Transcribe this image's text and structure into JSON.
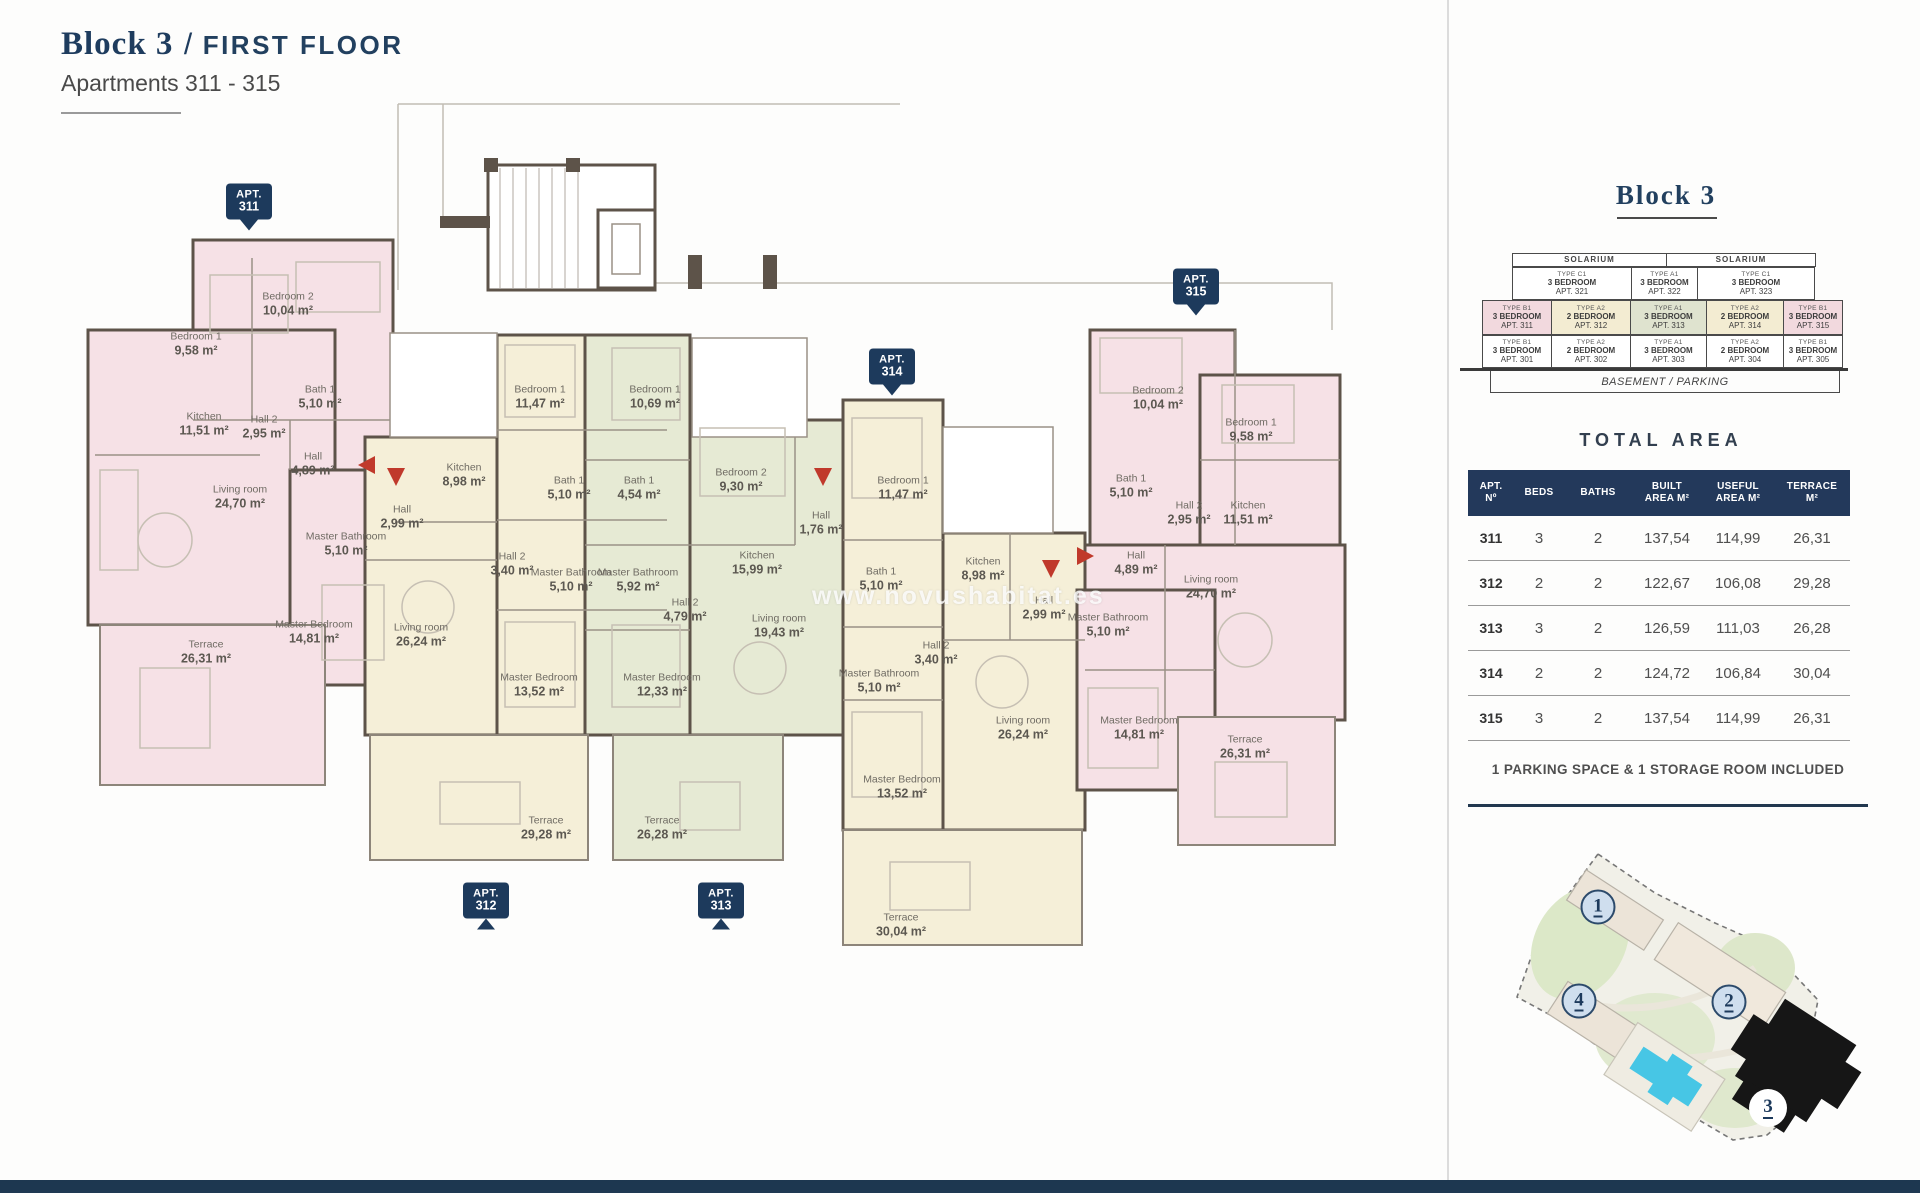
{
  "page": {
    "title_block": "Block 3",
    "title_sep": "/",
    "title_floor": "FIRST FLOOR",
    "subtitle": "Apartments 311 - 315",
    "watermark": "www.novushabitat.es"
  },
  "plan": {
    "badge_word": "APT.",
    "badges": [
      {
        "number": "311",
        "x": 249,
        "y": 207,
        "dir": "down"
      },
      {
        "number": "312",
        "x": 486,
        "y": 906,
        "dir": "up"
      },
      {
        "number": "313",
        "x": 721,
        "y": 906,
        "dir": "up"
      },
      {
        "number": "314",
        "x": 892,
        "y": 372,
        "dir": "down"
      },
      {
        "number": "315",
        "x": 1196,
        "y": 292,
        "dir": "down"
      }
    ],
    "apartments": [
      {
        "id": "311",
        "color": "pink",
        "rooms": [
          {
            "name": "Bedroom 2",
            "area": "10,04 m²",
            "x": 288,
            "y": 305
          },
          {
            "name": "Bedroom 1",
            "area": "9,58 m²",
            "x": 196,
            "y": 345
          },
          {
            "name": "Kitchen",
            "area": "11,51 m²",
            "x": 204,
            "y": 425
          },
          {
            "name": "Hall 2",
            "area": "2,95 m²",
            "x": 264,
            "y": 428
          },
          {
            "name": "Bath 1",
            "area": "5,10 m²",
            "x": 320,
            "y": 398
          },
          {
            "name": "Hall",
            "area": "4,89 m²",
            "x": 313,
            "y": 465
          },
          {
            "name": "Living room",
            "area": "24,70 m²",
            "x": 240,
            "y": 498
          },
          {
            "name": "Master Bathroom",
            "area": "5,10 m²",
            "x": 346,
            "y": 545
          },
          {
            "name": "Master Bedroom",
            "area": "14,81 m²",
            "x": 314,
            "y": 633
          },
          {
            "name": "Terrace",
            "area": "26,31 m²",
            "x": 206,
            "y": 653
          }
        ]
      },
      {
        "id": "312",
        "color": "cream",
        "rooms": [
          {
            "name": "Bedroom 1",
            "area": "11,47 m²",
            "x": 540,
            "y": 398
          },
          {
            "name": "Kitchen",
            "area": "8,98 m²",
            "x": 464,
            "y": 476
          },
          {
            "name": "Hall",
            "area": "2,99 m²",
            "x": 402,
            "y": 518
          },
          {
            "name": "Bath 1",
            "area": "5,10 m²",
            "x": 569,
            "y": 489
          },
          {
            "name": "Hall 2",
            "area": "3,40 m²",
            "x": 512,
            "y": 565
          },
          {
            "name": "Master Bathroom",
            "area": "5,10 m²",
            "x": 571,
            "y": 581
          },
          {
            "name": "Living room",
            "area": "26,24 m²",
            "x": 421,
            "y": 636
          },
          {
            "name": "Master Bedroom",
            "area": "13,52 m²",
            "x": 539,
            "y": 686
          },
          {
            "name": "Terrace",
            "area": "29,28 m²",
            "x": 546,
            "y": 829
          }
        ]
      },
      {
        "id": "313",
        "color": "green",
        "rooms": [
          {
            "name": "Bedroom 1",
            "area": "10,69 m²",
            "x": 655,
            "y": 398
          },
          {
            "name": "Bath 1",
            "area": "4,54 m²",
            "x": 639,
            "y": 489
          },
          {
            "name": "Bedroom 2",
            "area": "9,30 m²",
            "x": 741,
            "y": 481
          },
          {
            "name": "Hall",
            "area": "1,76 m²",
            "x": 821,
            "y": 524
          },
          {
            "name": "Kitchen",
            "area": "15,99 m²",
            "x": 757,
            "y": 564
          },
          {
            "name": "Master Bathroom",
            "area": "5,92 m²",
            "x": 638,
            "y": 581
          },
          {
            "name": "Hall 2",
            "area": "4,79 m²",
            "x": 685,
            "y": 611
          },
          {
            "name": "Living room",
            "area": "19,43 m²",
            "x": 779,
            "y": 627
          },
          {
            "name": "Master Bedroom",
            "area": "12,33 m²",
            "x": 662,
            "y": 686
          },
          {
            "name": "Terrace",
            "area": "26,28 m²",
            "x": 662,
            "y": 829
          }
        ]
      },
      {
        "id": "314",
        "color": "cream",
        "rooms": [
          {
            "name": "Bedroom 1",
            "area": "11,47 m²",
            "x": 903,
            "y": 489
          },
          {
            "name": "Bath 1",
            "area": "5,10 m²",
            "x": 881,
            "y": 580
          },
          {
            "name": "Kitchen",
            "area": "8,98 m²",
            "x": 983,
            "y": 570
          },
          {
            "name": "Hall",
            "area": "2,99 m²",
            "x": 1044,
            "y": 609
          },
          {
            "name": "Hall 2",
            "area": "3,40 m²",
            "x": 936,
            "y": 654
          },
          {
            "name": "Master Bathroom",
            "area": "5,10 m²",
            "x": 879,
            "y": 682
          },
          {
            "name": "Living room",
            "area": "26,24 m²",
            "x": 1023,
            "y": 729
          },
          {
            "name": "Master Bedroom",
            "area": "13,52 m²",
            "x": 902,
            "y": 788
          },
          {
            "name": "Terrace",
            "area": "30,04 m²",
            "x": 901,
            "y": 926
          }
        ]
      },
      {
        "id": "315",
        "color": "pink",
        "rooms": [
          {
            "name": "Bedroom 2",
            "area": "10,04 m²",
            "x": 1158,
            "y": 399
          },
          {
            "name": "Bedroom 1",
            "area": "9,58 m²",
            "x": 1251,
            "y": 431
          },
          {
            "name": "Bath 1",
            "area": "5,10 m²",
            "x": 1131,
            "y": 487
          },
          {
            "name": "Hall 2",
            "area": "2,95 m²",
            "x": 1189,
            "y": 514
          },
          {
            "name": "Kitchen",
            "area": "11,51 m²",
            "x": 1248,
            "y": 514
          },
          {
            "name": "Hall",
            "area": "4,89 m²",
            "x": 1136,
            "y": 564
          },
          {
            "name": "Living room",
            "area": "24,70 m²",
            "x": 1211,
            "y": 588
          },
          {
            "name": "Master Bathroom",
            "area": "5,10 m²",
            "x": 1108,
            "y": 626
          },
          {
            "name": "Master Bedroom",
            "area": "14,81 m²",
            "x": 1139,
            "y": 729
          },
          {
            "name": "Terrace",
            "area": "26,31 m²",
            "x": 1245,
            "y": 748
          }
        ]
      }
    ]
  },
  "sidebar": {
    "block_title": "Block 3",
    "stack": {
      "solarium": [
        "SOLARIUM",
        "SOLARIUM"
      ],
      "third_floor": [
        {
          "type": "TYPE C1",
          "beds": "3 BEDROOM",
          "apt": "APT. 321",
          "color": "white"
        },
        {
          "type": "TYPE A1",
          "beds": "3 BEDROOM",
          "apt": "APT. 322",
          "color": "white"
        },
        {
          "type": "TYPE C1",
          "beds": "3 BEDROOM",
          "apt": "APT. 323",
          "color": "white"
        }
      ],
      "first_floor": [
        {
          "type": "TYPE B1",
          "beds": "3 BEDROOM",
          "apt": "APT. 311",
          "color": "pink"
        },
        {
          "type": "TYPE A2",
          "beds": "2 BEDROOM",
          "apt": "APT. 312",
          "color": "cream"
        },
        {
          "type": "TYPE A1",
          "beds": "3 BEDROOM",
          "apt": "APT. 313",
          "color": "green"
        },
        {
          "type": "TYPE A2",
          "beds": "2 BEDROOM",
          "apt": "APT. 314",
          "color": "cream"
        },
        {
          "type": "TYPE B1",
          "beds": "3 BEDROOM",
          "apt": "APT. 315",
          "color": "pink"
        }
      ],
      "ground_floor": [
        {
          "type": "TYPE B1",
          "beds": "3 BEDROOM",
          "apt": "APT. 301",
          "color": "white"
        },
        {
          "type": "TYPE A2",
          "beds": "2 BEDROOM",
          "apt": "APT. 302",
          "color": "white"
        },
        {
          "type": "TYPE A1",
          "beds": "3 BEDROOM",
          "apt": "APT. 303",
          "color": "white"
        },
        {
          "type": "TYPE A2",
          "beds": "2 BEDROOM",
          "apt": "APT. 304",
          "color": "white"
        },
        {
          "type": "TYPE B1",
          "beds": "3 BEDROOM",
          "apt": "APT. 305",
          "color": "white"
        }
      ],
      "basement": "BASEMENT / PARKING"
    },
    "total_area": {
      "title": "TOTAL AREA",
      "columns": [
        "APT.\nNº",
        "BEDS",
        "BATHS",
        "BUILT\nAREA M²",
        "USEFUL\nAREA M²",
        "TERRACE\nM²"
      ],
      "rows": [
        {
          "apt": "311",
          "beds": "3",
          "baths": "2",
          "built": "137,54",
          "useful": "114,99",
          "terrace": "26,31"
        },
        {
          "apt": "312",
          "beds": "2",
          "baths": "2",
          "built": "122,67",
          "useful": "106,08",
          "terrace": "29,28"
        },
        {
          "apt": "313",
          "beds": "3",
          "baths": "2",
          "built": "126,59",
          "useful": "111,03",
          "terrace": "26,28"
        },
        {
          "apt": "314",
          "beds": "2",
          "baths": "2",
          "built": "124,72",
          "useful": "106,84",
          "terrace": "30,04"
        },
        {
          "apt": "315",
          "beds": "3",
          "baths": "2",
          "built": "137,54",
          "useful": "114,99",
          "terrace": "26,31"
        }
      ]
    },
    "note": "1 PARKING SPACE & 1 STORAGE ROOM INCLUDED",
    "site_map": {
      "markers": [
        {
          "n": "1",
          "x": 1598,
          "y": 907,
          "highlight": false
        },
        {
          "n": "4",
          "x": 1579,
          "y": 1001,
          "highlight": false
        },
        {
          "n": "2",
          "x": 1729,
          "y": 1002,
          "highlight": false
        },
        {
          "n": "3",
          "x": 1768,
          "y": 1108,
          "highlight": true
        }
      ]
    }
  },
  "colors": {
    "navy": "#1d3a5c",
    "pink": "#f6e1e6",
    "cream": "#f5efd8",
    "green": "#e6ead4",
    "wall": "#5d5349",
    "entry_red": "#c0392b"
  }
}
